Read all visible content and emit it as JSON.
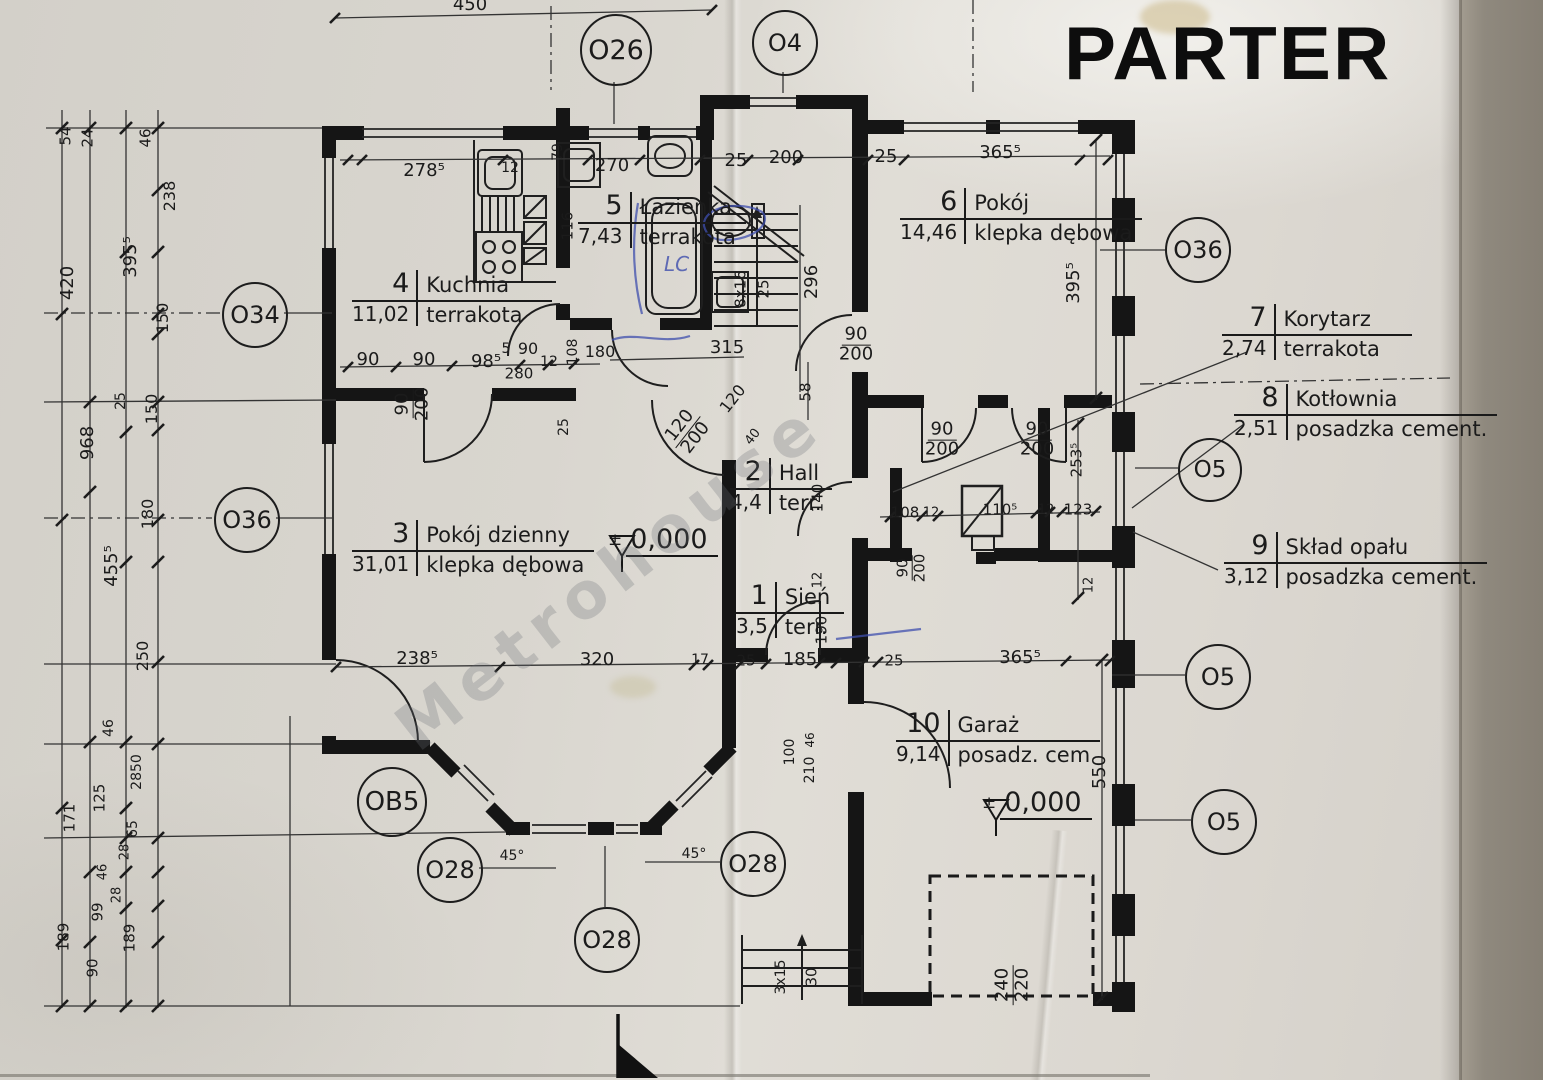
{
  "title": "PARTER",
  "watermark": "Metrohouse",
  "blue_note": "LC",
  "rooms": [
    {
      "num": "1",
      "name": "Sień",
      "area": "3,5",
      "floor": "terr.",
      "x": 736,
      "y": 582,
      "w": 108
    },
    {
      "num": "2",
      "name": "Hall",
      "area": "4,4",
      "floor": "terr.",
      "x": 730,
      "y": 458,
      "w": 100
    },
    {
      "num": "3",
      "name": "Pokój dzienny",
      "area": "31,01",
      "floor": "klepka dębowa",
      "x": 352,
      "y": 520,
      "w": 235
    },
    {
      "num": "4",
      "name": "Kuchnia",
      "area": "11,02",
      "floor": "terrakota",
      "x": 352,
      "y": 270,
      "w": 200
    },
    {
      "num": "5",
      "name": "Łazienka",
      "area": "7,43",
      "floor": "terrakota",
      "x": 578,
      "y": 192,
      "w": 160
    },
    {
      "num": "6",
      "name": "Pokój",
      "area": "14,46",
      "floor": "klepka dębowa",
      "x": 900,
      "y": 188,
      "w": 200
    },
    {
      "num": "7",
      "name": "Korytarz",
      "area": "2,74",
      "floor": "terrakota",
      "x": 1222,
      "y": 304,
      "w": 190
    },
    {
      "num": "8",
      "name": "Kotłownia",
      "area": "2,51",
      "floor": "posadzka cement.",
      "x": 1234,
      "y": 384,
      "w": 212
    },
    {
      "num": "9",
      "name": "Skład opału",
      "area": "3,12",
      "floor": "posadzka cement.",
      "x": 1224,
      "y": 532,
      "w": 215
    },
    {
      "num": "10",
      "name": "Garaż",
      "area": "9,14",
      "floor": "posadz. cem",
      "x": 896,
      "y": 710,
      "w": 195
    }
  ],
  "markers": [
    {
      "label": "O26",
      "x": 614,
      "y": 48,
      "r": 34
    },
    {
      "label": "O4",
      "x": 783,
      "y": 41,
      "r": 31
    },
    {
      "label": "O34",
      "x": 253,
      "y": 313,
      "r": 31
    },
    {
      "label": "O36",
      "x": 245,
      "y": 518,
      "r": 31
    },
    {
      "label": "O36",
      "x": 1196,
      "y": 248,
      "r": 31
    },
    {
      "label": "O5",
      "x": 1208,
      "y": 468,
      "r": 30
    },
    {
      "label": "O5",
      "x": 1216,
      "y": 675,
      "r": 31
    },
    {
      "label": "O5",
      "x": 1222,
      "y": 820,
      "r": 31
    },
    {
      "label": "OB5",
      "x": 390,
      "y": 800,
      "r": 33
    },
    {
      "label": "O28",
      "x": 448,
      "y": 868,
      "r": 31
    },
    {
      "label": "O28",
      "x": 751,
      "y": 862,
      "r": 31
    },
    {
      "label": "O28",
      "x": 605,
      "y": 938,
      "r": 31
    }
  ],
  "levels": [
    {
      "pm": "±",
      "val": "0,000",
      "x": 608,
      "y": 524
    },
    {
      "pm": "±",
      "val": "0,000",
      "x": 982,
      "y": 787
    }
  ],
  "dims": [
    {
      "t": "450",
      "x": 470,
      "y": 5
    },
    {
      "t": "278⁵",
      "x": 424,
      "y": 171
    },
    {
      "t": "12",
      "x": 510,
      "y": 168,
      "s": 14
    },
    {
      "t": "270",
      "x": 612,
      "y": 166
    },
    {
      "t": "25",
      "x": 736,
      "y": 161
    },
    {
      "t": "200",
      "x": 786,
      "y": 158
    },
    {
      "t": "25",
      "x": 886,
      "y": 157
    },
    {
      "t": "365⁵",
      "x": 1000,
      "y": 153
    },
    {
      "t": "79",
      "x": 558,
      "y": 152,
      "r": -90,
      "s": 14
    },
    {
      "t": "116",
      "x": 568,
      "y": 226,
      "r": -90,
      "s": 15
    },
    {
      "t": "296",
      "x": 812,
      "y": 282,
      "r": -90
    },
    {
      "t": "395⁵",
      "x": 1074,
      "y": 283,
      "r": -90
    },
    {
      "t": "8x16",
      "x": 741,
      "y": 289,
      "r": -90,
      "s": 15
    },
    {
      "t": "25",
      "x": 764,
      "y": 289,
      "r": -90,
      "s": 15
    },
    {
      "t": "54",
      "x": 66,
      "y": 136,
      "r": -90,
      "s": 15
    },
    {
      "t": "24",
      "x": 88,
      "y": 138,
      "r": -90,
      "s": 15
    },
    {
      "t": "46",
      "x": 146,
      "y": 138,
      "r": -90,
      "s": 15
    },
    {
      "t": "238",
      "x": 170,
      "y": 196,
      "r": -90,
      "s": 16
    },
    {
      "t": "395⁵",
      "x": 131,
      "y": 257,
      "r": -90
    },
    {
      "t": "420",
      "x": 68,
      "y": 283,
      "r": -90
    },
    {
      "t": "150",
      "x": 163,
      "y": 318,
      "r": -90,
      "s": 16
    },
    {
      "t": "25",
      "x": 121,
      "y": 401,
      "r": -90,
      "s": 14
    },
    {
      "t": "150",
      "x": 152,
      "y": 409,
      "r": -90,
      "s": 16
    },
    {
      "t": "968",
      "x": 88,
      "y": 443,
      "r": -90
    },
    {
      "t": "180",
      "x": 148,
      "y": 514,
      "r": -90,
      "s": 16
    },
    {
      "t": "455⁵",
      "x": 112,
      "y": 566,
      "r": -90
    },
    {
      "t": "250",
      "x": 143,
      "y": 656,
      "r": -90,
      "s": 16
    },
    {
      "t": "46",
      "x": 109,
      "y": 728,
      "r": -90,
      "s": 14
    },
    {
      "t": "2850",
      "x": 137,
      "y": 772,
      "r": -90,
      "s": 14
    },
    {
      "t": "125",
      "x": 100,
      "y": 798,
      "r": -90,
      "s": 15
    },
    {
      "t": "65",
      "x": 133,
      "y": 829,
      "r": -90,
      "s": 14
    },
    {
      "t": "28",
      "x": 125,
      "y": 852,
      "r": -90,
      "s": 13
    },
    {
      "t": "171",
      "x": 70,
      "y": 818,
      "r": -90,
      "s": 15
    },
    {
      "t": "46",
      "x": 103,
      "y": 872,
      "r": -90,
      "s": 13
    },
    {
      "t": "28",
      "x": 117,
      "y": 895,
      "r": -90,
      "s": 13
    },
    {
      "t": "99",
      "x": 98,
      "y": 912,
      "r": -90,
      "s": 15
    },
    {
      "t": "189",
      "x": 64,
      "y": 937,
      "r": -90,
      "s": 15
    },
    {
      "t": "189",
      "x": 130,
      "y": 938,
      "r": -90,
      "s": 15
    },
    {
      "t": "90",
      "x": 93,
      "y": 968,
      "r": -90,
      "s": 15
    },
    {
      "t": "90",
      "x": 368,
      "y": 360
    },
    {
      "t": "90",
      "x": 424,
      "y": 360
    },
    {
      "t": "98⁵",
      "x": 486,
      "y": 362
    },
    {
      "t": "5",
      "x": 506,
      "y": 349,
      "s": 14
    },
    {
      "t": "90",
      "x": 528,
      "y": 349,
      "s": 16
    },
    {
      "t": "280",
      "x": 519,
      "y": 374,
      "s": 15
    },
    {
      "t": "12",
      "x": 549,
      "y": 362,
      "s": 14
    },
    {
      "t": "108",
      "x": 573,
      "y": 352,
      "r": -90,
      "s": 14
    },
    {
      "t": "180",
      "x": 600,
      "y": 352,
      "s": 16
    },
    {
      "t": "90",
      "b": "200",
      "x": 413,
      "y": 404,
      "r": -90
    },
    {
      "t": "25",
      "x": 564,
      "y": 427,
      "r": -90,
      "s": 14
    },
    {
      "t": "315",
      "x": 727,
      "y": 348
    },
    {
      "t": "120",
      "x": 733,
      "y": 399,
      "r": -52,
      "s": 16
    },
    {
      "t": "40",
      "x": 753,
      "y": 437,
      "r": -52,
      "s": 13
    },
    {
      "t": "120",
      "b": "200",
      "x": 688,
      "y": 432,
      "r": -52
    },
    {
      "t": "90",
      "b": "200",
      "x": 856,
      "y": 345
    },
    {
      "t": "58",
      "x": 806,
      "y": 392,
      "r": -90,
      "s": 15
    },
    {
      "t": "90",
      "b": "200",
      "x": 942,
      "y": 440
    },
    {
      "t": "90",
      "b": "200",
      "x": 1037,
      "y": 440
    },
    {
      "t": "140",
      "x": 818,
      "y": 498,
      "r": -90,
      "s": 15
    },
    {
      "t": "90",
      "b": "200",
      "x": 912,
      "y": 568,
      "r": -90,
      "s": 15
    },
    {
      "t": "12",
      "x": 818,
      "y": 580,
      "r": -90,
      "s": 13
    },
    {
      "t": "190",
      "x": 822,
      "y": 630,
      "r": -90,
      "s": 15
    },
    {
      "t": "108",
      "x": 905,
      "y": 513,
      "s": 15
    },
    {
      "t": "12",
      "x": 931,
      "y": 513,
      "s": 13
    },
    {
      "t": "110⁵",
      "x": 1000,
      "y": 510,
      "s": 15
    },
    {
      "t": "12",
      "x": 1046,
      "y": 510,
      "s": 13
    },
    {
      "t": "123",
      "x": 1078,
      "y": 510,
      "s": 15
    },
    {
      "t": "253⁵",
      "x": 1077,
      "y": 460,
      "r": -90,
      "s": 15
    },
    {
      "t": "12",
      "x": 1089,
      "y": 585,
      "r": -90,
      "s": 13
    },
    {
      "t": "238⁵",
      "x": 417,
      "y": 659
    },
    {
      "t": "320",
      "x": 597,
      "y": 660
    },
    {
      "t": "17",
      "x": 700,
      "y": 660,
      "s": 14
    },
    {
      "t": "25",
      "x": 746,
      "y": 661,
      "s": 15
    },
    {
      "t": "185",
      "x": 800,
      "y": 660
    },
    {
      "t": "25",
      "x": 894,
      "y": 661,
      "s": 15
    },
    {
      "t": "365⁵",
      "x": 1020,
      "y": 658
    },
    {
      "t": "100",
      "x": 790,
      "y": 752,
      "r": -90,
      "s": 14
    },
    {
      "t": "210",
      "x": 810,
      "y": 770,
      "r": -90,
      "s": 14
    },
    {
      "t": "46",
      "x": 810,
      "y": 740,
      "r": -90,
      "s": 12
    },
    {
      "t": "550",
      "x": 1100,
      "y": 772,
      "r": -90
    },
    {
      "t": "240",
      "b": "220",
      "x": 1013,
      "y": 985,
      "r": -90
    },
    {
      "t": "3x15",
      "x": 781,
      "y": 977,
      "r": -90,
      "s": 14
    },
    {
      "t": "30",
      "x": 812,
      "y": 977,
      "r": -90,
      "s": 15
    },
    {
      "t": "45°",
      "x": 512,
      "y": 856,
      "s": 14
    },
    {
      "t": "45°",
      "x": 694,
      "y": 854,
      "s": 14
    }
  ]
}
